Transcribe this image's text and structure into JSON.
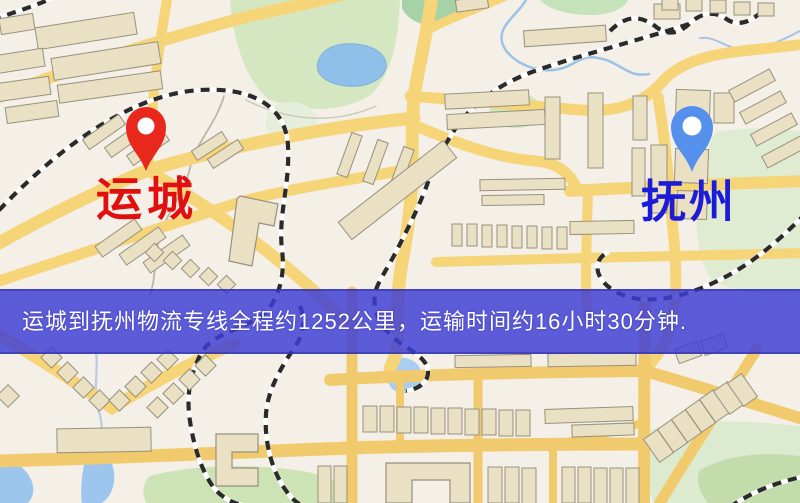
{
  "map": {
    "origin": {
      "name": "运城",
      "pin_color": "#e8271d",
      "label_color": "#e01010"
    },
    "destination": {
      "name": "抚州",
      "pin_color": "#5590ec",
      "label_color": "#1c1cd8"
    },
    "banner": {
      "text": "运城到抚州物流专线全程约1252公里，运输时间约16小时30分钟.",
      "background_color": "#3e3ed5",
      "text_color": "#ffffff"
    },
    "palette": {
      "background": "#f4efe7",
      "road": "#f6d478",
      "road_grid": "#f2ca6e",
      "water": "#8fc0ea",
      "park": "#d5e7c1",
      "building": "#eae0c3",
      "railway": "#2a2a2a"
    }
  }
}
